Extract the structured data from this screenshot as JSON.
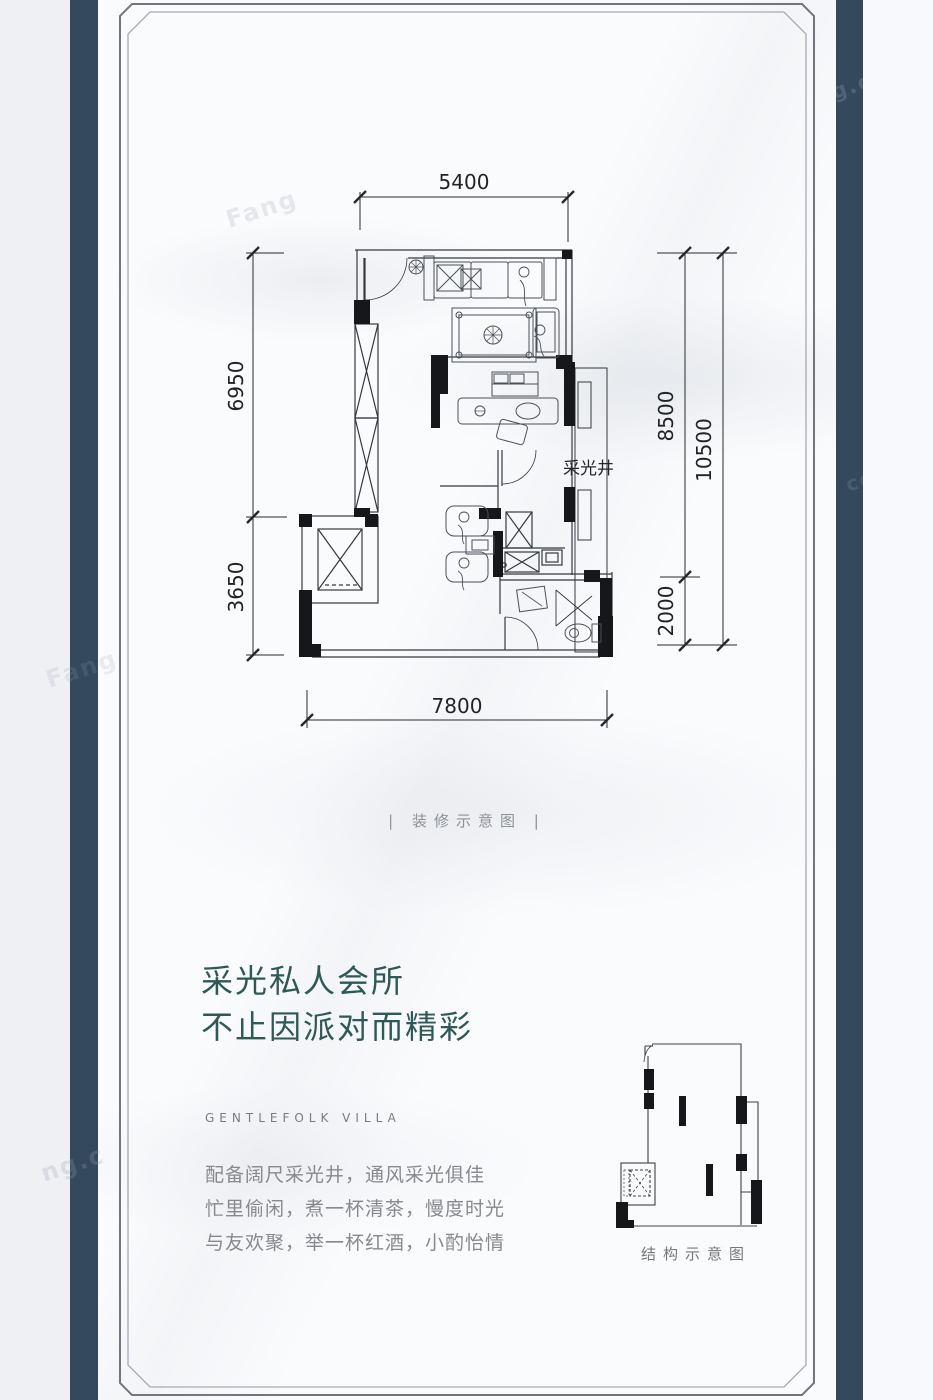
{
  "page": {
    "background_color": "#fafbfd",
    "side_bar_color": "#35495c",
    "accent_color": "#2e5956"
  },
  "floor_plan": {
    "light_well_label": "采光井",
    "caption": "| 装修示意图 |",
    "dimensions": {
      "top": "5400",
      "left_upper": "6950",
      "left_lower": "3650",
      "right_inner_upper": "8500",
      "right_inner_lower": "2000",
      "right_outer": "10500",
      "bottom": "7800"
    }
  },
  "structure_plan": {
    "caption": "结构示意图"
  },
  "marketing": {
    "headline_line1": "采光私人会所",
    "headline_line2": "不止因派对而精彩",
    "logo_text": "GENTLEFOLK VILLA",
    "body_lines": [
      "配备阔尺采光井，通风采光俱佳",
      "忙里偷闲，煮一杯清茶，慢度时光",
      "与友欢聚，举一杯红酒，小酌怡情"
    ]
  },
  "watermarks": [
    "Fang",
    "g.com",
    "ng.c",
    "com",
    "Fang"
  ]
}
